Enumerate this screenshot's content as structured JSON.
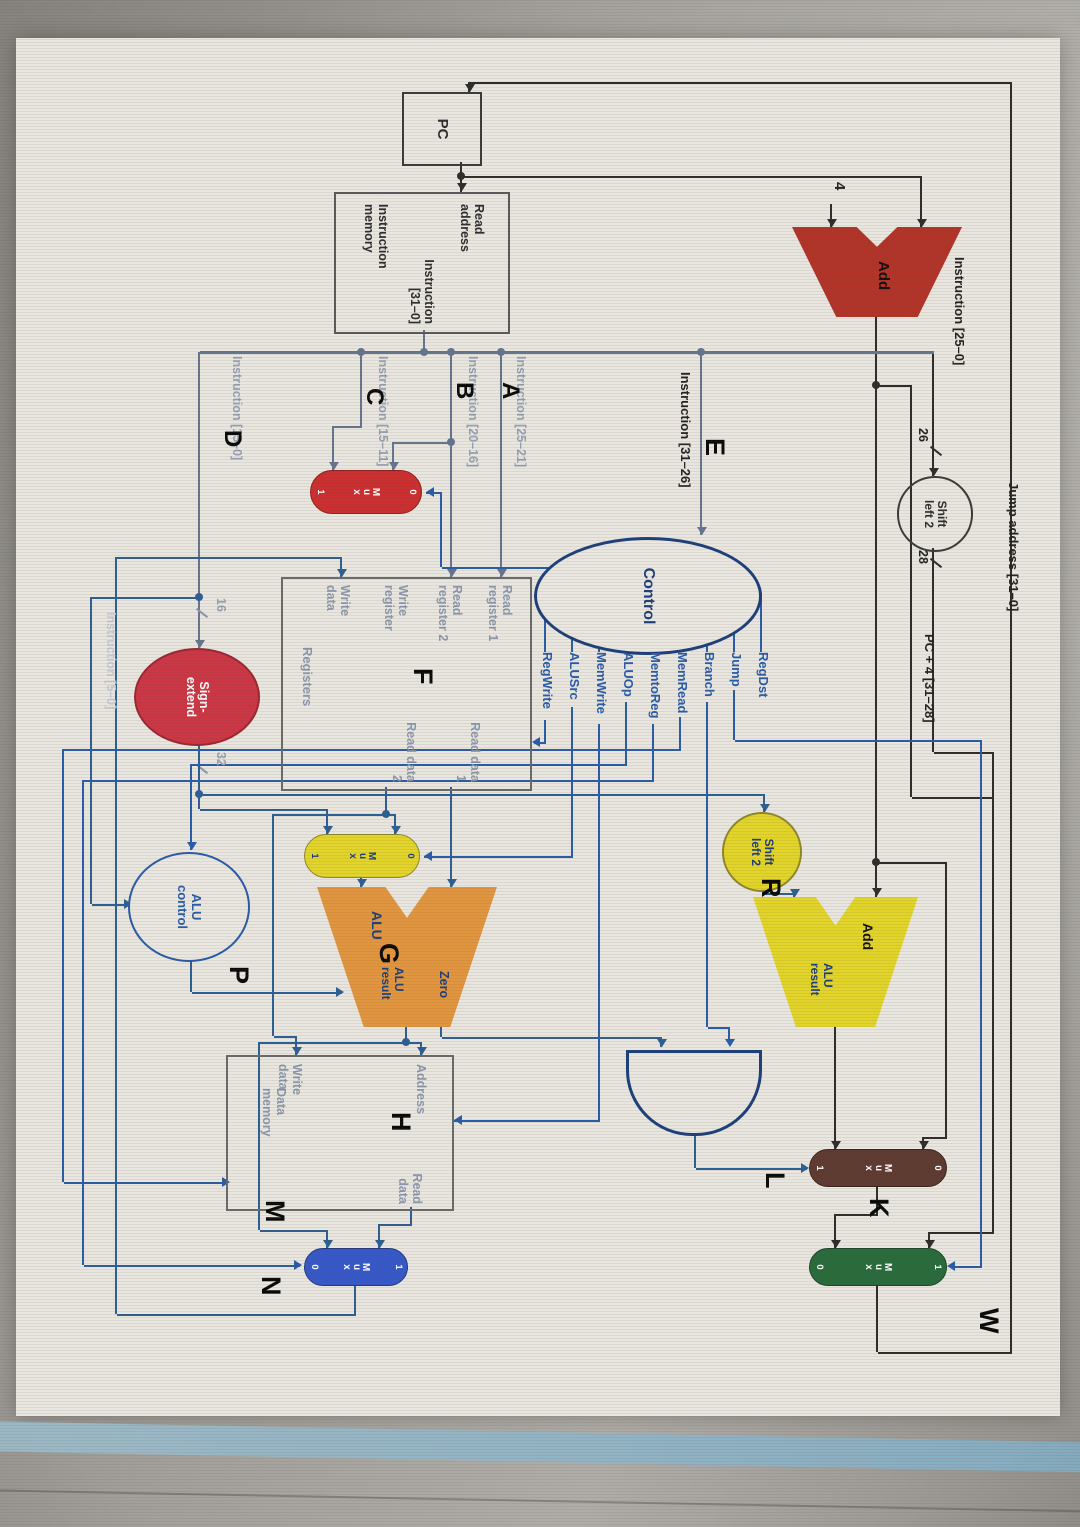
{
  "figure": {
    "letters": {
      "w": "W",
      "e": "E",
      "a": "A",
      "b": "B",
      "c": "C",
      "d": "D",
      "f": "F",
      "g": "G",
      "h": "H",
      "k": "K",
      "l": "L",
      "m": "M",
      "n": "N",
      "p": "P",
      "r": "R"
    },
    "pc": "PC",
    "const4": "4",
    "imem": {
      "read_address": "Read address",
      "out": "Instruction [31–0]",
      "title": "Instruction memory"
    },
    "add_pc": "Add",
    "shift_jump": "Shift left 2",
    "tick26": "26",
    "tick28": "28",
    "instr_25_0": "Instruction [25–0]",
    "jump_address": "Jump address [31–0]",
    "pc_plus4": "PC + 4 [31–28]",
    "instr_31_26": "Instruction [31–26]",
    "control": {
      "title": "Control",
      "signals": [
        "RegDst",
        "Jump",
        "Branch",
        "MemRead",
        "MemtoReg",
        "ALUOp",
        "MemWrite",
        "ALUSrc",
        "RegWrite"
      ]
    },
    "instr_25_21": "Instruction [25–21]",
    "instr_20_16": "Instruction [20–16]",
    "instr_15_11": "Instruction [15–11]",
    "instr_15_0": "Instruction [15–0]",
    "instr_5_0": "Instruction [5–0]",
    "registers": {
      "title": "Registers",
      "read_reg1": "Read register 1",
      "read_reg2": "Read register 2",
      "write_reg": "Write register",
      "write_data": "Write data",
      "read_data1": "Read data 1",
      "read_data2": "Read data 2"
    },
    "sign_extend": "Sign-extend",
    "tick16": "16",
    "tick32": "32",
    "shift_branch": "Shift left 2",
    "add_branch": {
      "title": "Add",
      "result": "ALU result"
    },
    "alu": {
      "title": "ALU",
      "zero": "Zero",
      "result": "ALU result"
    },
    "alu_control": "ALU control",
    "dmem": {
      "title": "Data memory",
      "address": "Address",
      "read_data": "Read data",
      "write_data": "Write data"
    },
    "mux": {
      "label": "Mux",
      "zero": "0",
      "one": "1"
    }
  }
}
